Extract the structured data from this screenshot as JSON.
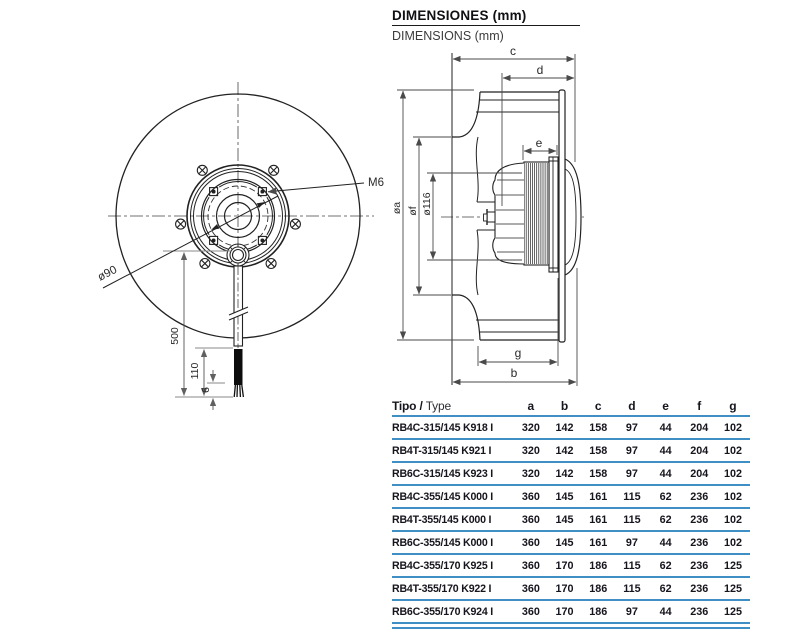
{
  "page": {
    "title": "DIMENSIONES (mm)",
    "subtitle": "DIMENSIONS (mm)"
  },
  "colors": {
    "accent_blue": "#3f8fc5",
    "drawing_line": "#222222",
    "dim_line_gray": "#8a8a8a"
  },
  "front_view": {
    "labels": {
      "thread": "M6",
      "bolt_circle_diameter": "ø90",
      "cable_length": "500",
      "cable_free_length": "110",
      "strip_length": "6"
    }
  },
  "side_view": {
    "labels": {
      "c": "c",
      "d": "d",
      "e": "e",
      "g": "g",
      "b": "b",
      "dia_a": "øa",
      "dia_f": "øf",
      "dia_116": "ø116"
    }
  },
  "table": {
    "header": {
      "type_bold": "Tipo /",
      "type_regular": "Type",
      "columns": [
        "a",
        "b",
        "c",
        "d",
        "e",
        "f",
        "g"
      ]
    },
    "rows": [
      {
        "type": "RB4C-315/145 K918 I",
        "values": [
          "320",
          "142",
          "158",
          "97",
          "44",
          "204",
          "102"
        ]
      },
      {
        "type": "RB4T-315/145 K921 I",
        "values": [
          "320",
          "142",
          "158",
          "97",
          "44",
          "204",
          "102"
        ]
      },
      {
        "type": "RB6C-315/145 K923 I",
        "values": [
          "320",
          "142",
          "158",
          "97",
          "44",
          "204",
          "102"
        ]
      },
      {
        "type": "RB4C-355/145 K000 I",
        "values": [
          "360",
          "145",
          "161",
          "115",
          "62",
          "236",
          "102"
        ]
      },
      {
        "type": "RB4T-355/145 K000 I",
        "values": [
          "360",
          "145",
          "161",
          "115",
          "62",
          "236",
          "102"
        ]
      },
      {
        "type": "RB6C-355/145 K000 I",
        "values": [
          "360",
          "145",
          "161",
          "97",
          "44",
          "236",
          "102"
        ]
      },
      {
        "type": "RB4C-355/170 K925 I",
        "values": [
          "360",
          "170",
          "186",
          "115",
          "62",
          "236",
          "125"
        ]
      },
      {
        "type": "RB4T-355/170 K922 I",
        "values": [
          "360",
          "170",
          "186",
          "115",
          "62",
          "236",
          "125"
        ]
      },
      {
        "type": "RB6C-355/170 K924 I",
        "values": [
          "360",
          "170",
          "186",
          "97",
          "44",
          "236",
          "125"
        ]
      }
    ]
  }
}
